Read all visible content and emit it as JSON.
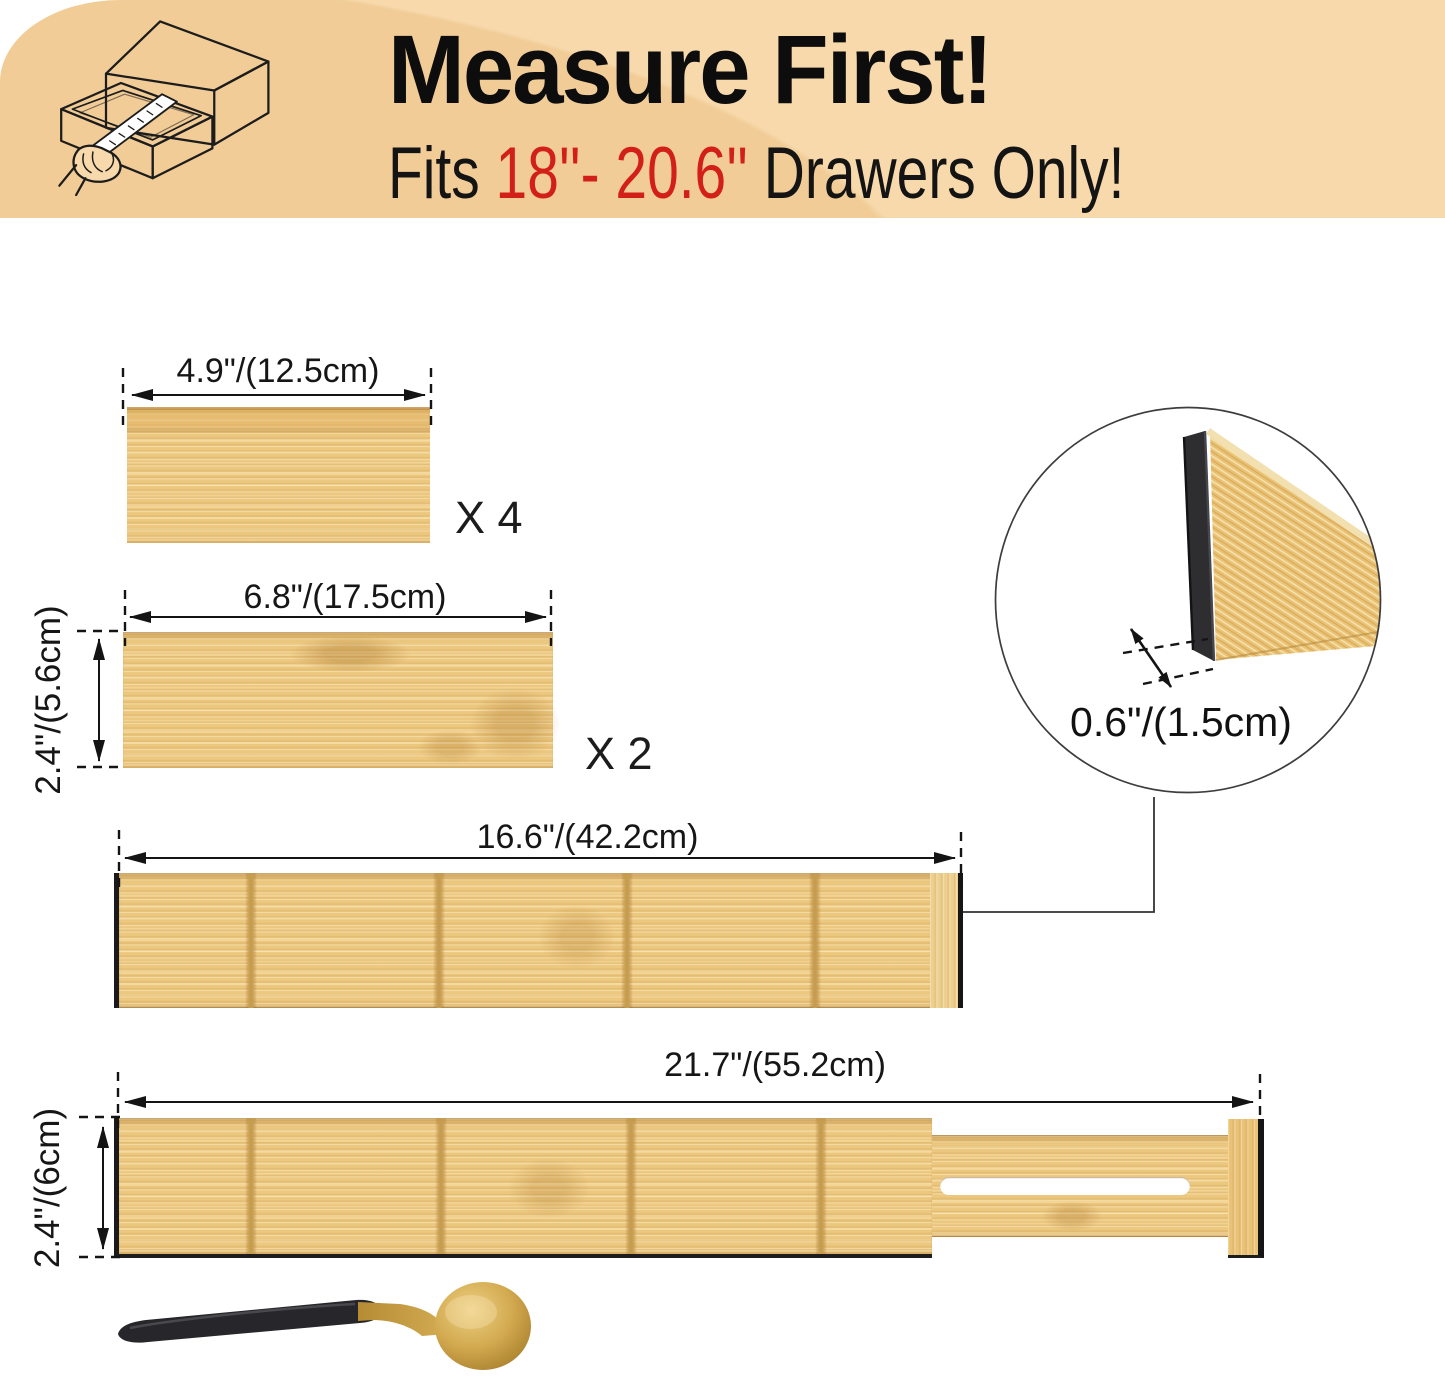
{
  "banner": {
    "title": "Measure First!",
    "fits_prefix": "Fits ",
    "fits_range": "18''- 20.6''",
    "fits_suffix": " Drawers Only!"
  },
  "boards": {
    "small": {
      "length_label": "4.9\"/(12.5cm)",
      "qty_label": "X 4"
    },
    "medium": {
      "length_label": "6.8\"/(17.5cm)",
      "qty_label": "X 2",
      "height_label": "2.4\"/(5.6cm)"
    },
    "long": {
      "length_label": "16.6\"/(42.2cm)"
    },
    "extended": {
      "length_label": "21.7\"/(55.2cm)",
      "height_label": "2.4\"/(6cm)"
    }
  },
  "inset": {
    "thickness_label": "0.6\"/(1.5cm)"
  },
  "colors": {
    "banner_bg": "#f7d9ab",
    "banner_blob": "#f1cc97",
    "accent_red": "#d21f18",
    "bamboo": "#ecc77e",
    "groove": "#c69c4f",
    "edge_black": "#1a1a1a",
    "spoon_handle": "#26262b",
    "spoon_gold": "#d2a94f"
  }
}
